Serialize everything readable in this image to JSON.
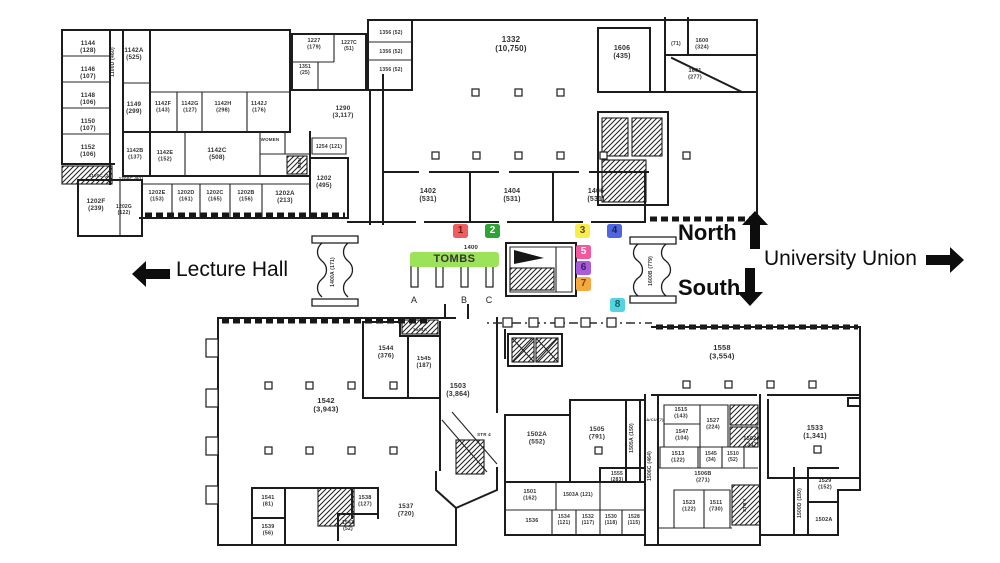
{
  "annotations": {
    "north": "North",
    "south": "South",
    "lecture_hall": "Lecture Hall",
    "university_union": "University Union"
  },
  "tombs": {
    "label": "TOMBS",
    "banner_color": "#9CE25A",
    "pillar_labels": [
      "A",
      "B",
      "C"
    ]
  },
  "markers": [
    {
      "label": "1",
      "color": "#F15C5C",
      "text_color": "#6b1d1d",
      "x": 453,
      "y": 224
    },
    {
      "label": "2",
      "color": "#2EA435",
      "text_color": "#ffffff",
      "x": 485,
      "y": 224
    },
    {
      "label": "3",
      "color": "#F9ED4B",
      "text_color": "#555023",
      "x": 575,
      "y": 224
    },
    {
      "label": "4",
      "color": "#4F66DC",
      "text_color": "#141f66",
      "x": 607,
      "y": 224
    },
    {
      "label": "5",
      "color": "#F2589D",
      "text_color": "#ffffff",
      "x": 576,
      "y": 245
    },
    {
      "label": "6",
      "color": "#A85CD9",
      "text_color": "#3d1b5e",
      "x": 576,
      "y": 261
    },
    {
      "label": "7",
      "color": "#F5A93F",
      "text_color": "#6e4a10",
      "x": 576,
      "y": 277
    },
    {
      "label": "8",
      "color": "#55D4E0",
      "text_color": "#135e66",
      "x": 610,
      "y": 298
    }
  ],
  "plan": {
    "rooms": [
      {
        "n": "1144",
        "a": "(128)",
        "x": 88,
        "y": 45
      },
      {
        "n": "1146",
        "a": "(107)",
        "x": 88,
        "y": 71
      },
      {
        "n": "1148",
        "a": "(106)",
        "x": 88,
        "y": 97
      },
      {
        "n": "1150",
        "a": "(107)",
        "x": 88,
        "y": 123
      },
      {
        "n": "1152",
        "a": "(106)",
        "x": 88,
        "y": 149
      },
      {
        "n": "1100D (460)",
        "x": 114,
        "y": 62,
        "r": -90,
        "f": 5
      },
      {
        "n": "1142A",
        "a": "(525)",
        "x": 134,
        "y": 52
      },
      {
        "n": "1149",
        "a": "(299)",
        "x": 134,
        "y": 106
      },
      {
        "n": "1142F",
        "a": "(143)",
        "x": 163,
        "y": 105,
        "f": 5.5
      },
      {
        "n": "1142G",
        "a": "(127)",
        "x": 190,
        "y": 105,
        "f": 5.5
      },
      {
        "n": "1142H",
        "a": "(298)",
        "x": 223,
        "y": 105,
        "f": 5.5
      },
      {
        "n": "1142J",
        "a": "(176)",
        "x": 259,
        "y": 105,
        "f": 5.5
      },
      {
        "n": "1142B",
        "a": "(137)",
        "x": 135,
        "y": 152,
        "f": 5.5
      },
      {
        "n": "1142E",
        "a": "(152)",
        "x": 165,
        "y": 154,
        "f": 5.5
      },
      {
        "n": "1142C",
        "a": "(508)",
        "x": 217,
        "y": 152
      },
      {
        "n": "WOMEN",
        "x": 270,
        "y": 141,
        "f": 4.5
      },
      {
        "n": "MEN",
        "x": 301,
        "y": 163,
        "r": -90,
        "f": 4.5
      },
      {
        "n": "1254 (121)",
        "x": 329,
        "y": 148,
        "f": 5
      },
      {
        "n": "1100C (27)",
        "x": 101,
        "y": 177,
        "f": 4.5
      },
      {
        "n": "1200C (91)",
        "x": 131,
        "y": 180,
        "f": 4.5
      },
      {
        "n": "1202F",
        "a": "(239)",
        "x": 96,
        "y": 203
      },
      {
        "n": "1202G",
        "a": "(122)",
        "x": 124,
        "y": 208,
        "f": 5
      },
      {
        "n": "1202E",
        "a": "(153)",
        "x": 157,
        "y": 194,
        "f": 5.5
      },
      {
        "n": "1202D",
        "a": "(161)",
        "x": 186,
        "y": 194,
        "f": 5.5
      },
      {
        "n": "1202C",
        "a": "(165)",
        "x": 215,
        "y": 194,
        "f": 5.5
      },
      {
        "n": "1202B",
        "a": "(156)",
        "x": 246,
        "y": 194,
        "f": 5.5
      },
      {
        "n": "1202A",
        "a": "(213)",
        "x": 285,
        "y": 195
      },
      {
        "n": "1202",
        "a": "(495)",
        "x": 324,
        "y": 180
      },
      {
        "n": "1290",
        "a": "(3,117)",
        "x": 343,
        "y": 110
      },
      {
        "n": "1227",
        "a": "(179)",
        "x": 314,
        "y": 42,
        "f": 5.5
      },
      {
        "n": "1227C",
        "a": "(51)",
        "x": 349,
        "y": 44,
        "f": 5
      },
      {
        "n": "1351",
        "a": "(25)",
        "x": 305,
        "y": 68,
        "f": 5
      },
      {
        "n": "1356 (52)",
        "x": 391,
        "y": 34,
        "f": 5
      },
      {
        "n": "1356 (52)",
        "x": 391,
        "y": 53,
        "f": 5
      },
      {
        "n": "1356 (52)",
        "x": 391,
        "y": 71,
        "f": 5
      },
      {
        "n": "1332",
        "a": "(10,750)",
        "x": 511,
        "y": 42,
        "f": 8
      },
      {
        "n": "1402",
        "a": "(531)",
        "x": 428,
        "y": 193,
        "f": 7
      },
      {
        "n": "1404",
        "a": "(531)",
        "x": 512,
        "y": 193,
        "f": 7
      },
      {
        "n": "1406",
        "a": "(531)",
        "x": 596,
        "y": 193,
        "f": 7
      },
      {
        "n": "1400",
        "x": 471,
        "y": 249,
        "f": 6
      },
      {
        "n": "1606",
        "a": "(435)",
        "x": 622,
        "y": 50,
        "f": 7
      },
      {
        "n": "(71)",
        "x": 676,
        "y": 45,
        "f": 5
      },
      {
        "n": "1600",
        "a": "(324)",
        "x": 702,
        "y": 42,
        "f": 5.5
      },
      {
        "n": "1601",
        "a": "(277)",
        "x": 695,
        "y": 72,
        "f": 5.5
      },
      {
        "n": "1400A (171)",
        "x": 334,
        "y": 272,
        "r": -90,
        "f": 5
      },
      {
        "n": "1600B (779)",
        "x": 652,
        "y": 271,
        "r": -90,
        "f": 5
      },
      {
        "n": "1542",
        "a": "(3,943)",
        "x": 326,
        "y": 403,
        "f": 7.5
      },
      {
        "n": "1544",
        "a": "(376)",
        "x": 386,
        "y": 350,
        "f": 6.5
      },
      {
        "n": "1545",
        "a": "(187)",
        "x": 424,
        "y": 360,
        "f": 6
      },
      {
        "n": "1544A",
        "x": 420,
        "y": 331,
        "f": 4.5
      },
      {
        "n": "1503",
        "a": "(3,864)",
        "x": 458,
        "y": 388,
        "f": 7
      },
      {
        "n": "STR 4",
        "x": 484,
        "y": 436,
        "f": 4.5
      },
      {
        "n": "1541",
        "a": "(81)",
        "x": 268,
        "y": 499,
        "f": 5.5
      },
      {
        "n": "1539",
        "a": "(56)",
        "x": 268,
        "y": 528,
        "f": 5.5
      },
      {
        "n": "1538",
        "a": "(127)",
        "x": 365,
        "y": 499,
        "f": 5.5
      },
      {
        "n": "1543",
        "a": "(52)",
        "x": 348,
        "y": 524,
        "f": 5
      },
      {
        "n": "1537",
        "a": "(720)",
        "x": 406,
        "y": 508,
        "f": 6.5
      },
      {
        "n": "1558",
        "a": "(3,554)",
        "x": 722,
        "y": 350,
        "f": 7.5
      },
      {
        "n": "1533",
        "a": "(1,341)",
        "x": 815,
        "y": 430,
        "f": 7
      },
      {
        "n": "1502A",
        "a": "(552)",
        "x": 537,
        "y": 436,
        "f": 6.5
      },
      {
        "n": "1505",
        "a": "(791)",
        "x": 597,
        "y": 431,
        "f": 6.5
      },
      {
        "n": "1505A (150)",
        "x": 633,
        "y": 438,
        "r": -90,
        "f": 5
      },
      {
        "n": "1515",
        "a": "(143)",
        "x": 681,
        "y": 411,
        "f": 5.5
      },
      {
        "n": "A/CU (7)",
        "x": 655,
        "y": 421,
        "f": 4
      },
      {
        "n": "1547",
        "a": "(104)",
        "x": 682,
        "y": 433,
        "f": 5.5
      },
      {
        "n": "1527",
        "a": "(224)",
        "x": 713,
        "y": 422,
        "f": 5.5
      },
      {
        "n": "1513",
        "a": "(122)",
        "x": 678,
        "y": 455,
        "f": 5.5
      },
      {
        "n": "1545",
        "a": "(34)",
        "x": 711,
        "y": 455,
        "f": 5
      },
      {
        "n": "1510",
        "a": "(52)",
        "x": 733,
        "y": 455,
        "f": 5
      },
      {
        "n": "1506B",
        "a": "(271)",
        "x": 703,
        "y": 475,
        "f": 5.5
      },
      {
        "n": "1502A",
        "a": "(347)",
        "x": 752,
        "y": 440,
        "f": 5.5
      },
      {
        "n": "1506C (464)",
        "x": 651,
        "y": 466,
        "r": -90,
        "f": 5
      },
      {
        "n": "1523",
        "a": "(122)",
        "x": 689,
        "y": 504,
        "f": 5.5
      },
      {
        "n": "1511",
        "a": "(730)",
        "x": 716,
        "y": 504,
        "f": 5.5
      },
      {
        "n": "STR 1",
        "x": 746,
        "y": 505,
        "r": -90,
        "f": 4.5
      },
      {
        "n": "1500D (150)",
        "x": 801,
        "y": 503,
        "r": -90,
        "f": 5
      },
      {
        "n": "1529",
        "a": "(152)",
        "x": 825,
        "y": 482,
        "f": 5.5
      },
      {
        "n": "1502A",
        "x": 824,
        "y": 521,
        "f": 5.5
      },
      {
        "n": "1501",
        "a": "(162)",
        "x": 530,
        "y": 493,
        "f": 5.5
      },
      {
        "n": "1503A (121)",
        "x": 578,
        "y": 496,
        "f": 5
      },
      {
        "n": "1555",
        "a": "(283)",
        "x": 617,
        "y": 475,
        "f": 5
      },
      {
        "n": "1536",
        "x": 532,
        "y": 522,
        "f": 5.5
      },
      {
        "n": "1534",
        "a": "(121)",
        "x": 564,
        "y": 518,
        "f": 5
      },
      {
        "n": "1532",
        "a": "(117)",
        "x": 588,
        "y": 518,
        "f": 5
      },
      {
        "n": "1530",
        "a": "(118)",
        "x": 611,
        "y": 518,
        "f": 5
      },
      {
        "n": "1528",
        "a": "(115)",
        "x": 634,
        "y": 518,
        "f": 5
      }
    ]
  }
}
